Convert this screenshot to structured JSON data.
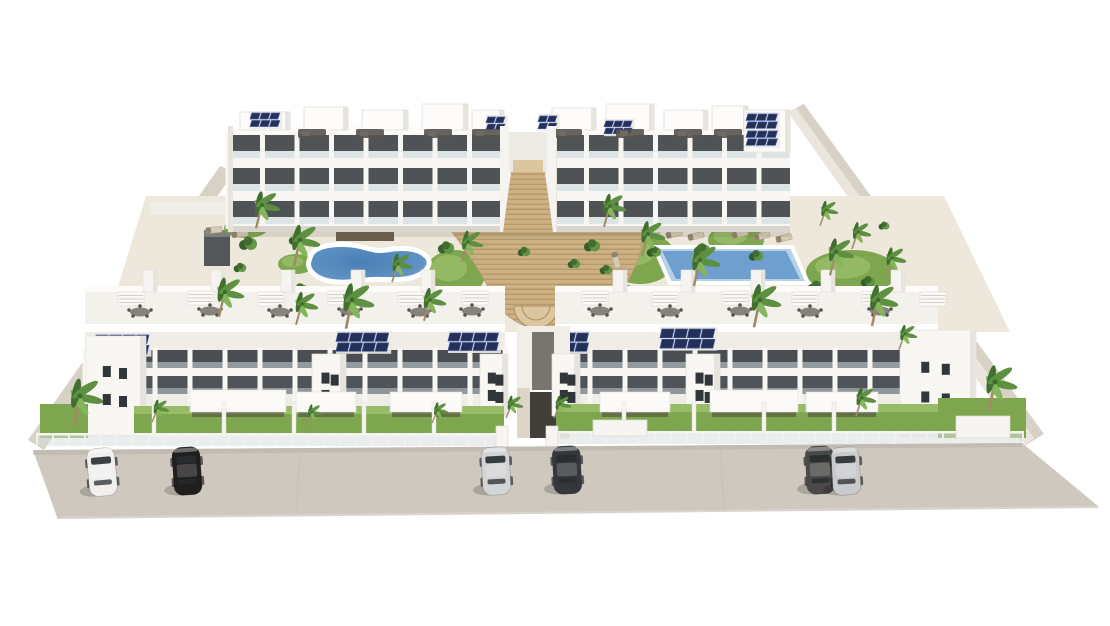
{
  "meta": {
    "type": "3d-architectural-rendering",
    "description": "Aerial 3D render of a white Mediterranean apartment complex: two rows of three-storey blocks around a landscaped courtyard with a kidney-shaped pool and a rectangular lap pool, curved timber deck stairs in the centre, palm trees, rooftop terraces with furniture, navy solar-panel arrays, a glass perimeter fence and six cars parked on a beige access road.",
    "background": "#ffffff",
    "floors_per_block": 3,
    "car_count": 6,
    "pool_count": 2
  },
  "palette": {
    "facade_white": "#f8f6f2",
    "facade_light": "#fdfcfa",
    "facade_shade": "#e7e4de",
    "facade_deep": "#d9d5ce",
    "window_dark": "#31363b",
    "glass_rail": "#ccd8dd",
    "solar_navy": "#233058",
    "solar_line": "#46579a",
    "palm_dark": "#3e6a2e",
    "palm_mid": "#5f9140",
    "palm_light": "#86b75e",
    "grass": "#7ea64e",
    "grass_light": "#a3c572",
    "bush_dark": "#2f5a26",
    "sand": "#ede8db",
    "deck_wood": "#cdb183",
    "deck_line": "#ab8f63",
    "deck_light": "#dcc6a0",
    "pool_deep": "#4a80b6",
    "pool_mid": "#6f9fce",
    "pool_pale": "#b7d2e6",
    "road": "#cfc8bf",
    "road_shade": "#b8b0a6",
    "wall_tan": "#d8d1c5",
    "furniture_gray": "#807c77",
    "furniture_dark": "#57534f",
    "trunk": "#a08b66",
    "canopy_shadow": "#4a453f",
    "alley_dark": "#413d38"
  },
  "scene": {
    "pools": [
      {
        "name": "kidney-pool",
        "shape": "organic"
      },
      {
        "name": "lap-pool",
        "shape": "rectangular"
      }
    ],
    "cars": [
      {
        "color_name": "white",
        "hex": "#f0efed",
        "x": 102,
        "y": 472,
        "rot": -5
      },
      {
        "color_name": "black",
        "hex": "#211f1e",
        "x": 187,
        "y": 471,
        "rot": -4
      },
      {
        "color_name": "silver",
        "hex": "#d3d4d6",
        "x": 496,
        "y": 471,
        "rot": -3
      },
      {
        "color_name": "graphite",
        "hex": "#35383b",
        "x": 567,
        "y": 470,
        "rot": -3
      },
      {
        "color_name": "dark-gray",
        "hex": "#4b4a48",
        "x": 820,
        "y": 470,
        "rot": -3
      },
      {
        "color_name": "silver",
        "hex": "#c9cacc",
        "x": 846,
        "y": 471,
        "rot": -3
      }
    ],
    "palms": [
      {
        "x": 262,
        "y": 205,
        "s": 0.9
      },
      {
        "x": 300,
        "y": 240,
        "s": 1.0
      },
      {
        "x": 225,
        "y": 292,
        "s": 0.95
      },
      {
        "x": 352,
        "y": 300,
        "s": 1.1
      },
      {
        "x": 398,
        "y": 264,
        "s": 0.7
      },
      {
        "x": 302,
        "y": 304,
        "s": 0.8
      },
      {
        "x": 468,
        "y": 242,
        "s": 0.75
      },
      {
        "x": 610,
        "y": 206,
        "s": 0.8
      },
      {
        "x": 648,
        "y": 234,
        "s": 0.85
      },
      {
        "x": 700,
        "y": 260,
        "s": 1.0
      },
      {
        "x": 760,
        "y": 300,
        "s": 1.05
      },
      {
        "x": 836,
        "y": 252,
        "s": 0.9
      },
      {
        "x": 878,
        "y": 300,
        "s": 1.0
      },
      {
        "x": 826,
        "y": 210,
        "s": 0.6
      },
      {
        "x": 858,
        "y": 232,
        "s": 0.65
      },
      {
        "x": 892,
        "y": 258,
        "s": 0.7
      },
      {
        "x": 80,
        "y": 396,
        "s": 1.15
      },
      {
        "x": 158,
        "y": 408,
        "s": 0.55
      },
      {
        "x": 995,
        "y": 382,
        "s": 1.1
      },
      {
        "x": 862,
        "y": 398,
        "s": 0.7
      },
      {
        "x": 512,
        "y": 404,
        "s": 0.55
      },
      {
        "x": 560,
        "y": 404,
        "s": 0.55
      },
      {
        "x": 312,
        "y": 412,
        "s": 0.5
      },
      {
        "x": 438,
        "y": 410,
        "s": 0.5
      },
      {
        "x": 905,
        "y": 334,
        "s": 0.6
      },
      {
        "x": 430,
        "y": 300,
        "s": 0.8
      }
    ],
    "bushes": [
      {
        "x": 248,
        "y": 244,
        "s": 1.0
      },
      {
        "x": 296,
        "y": 240,
        "s": 0.8
      },
      {
        "x": 446,
        "y": 248,
        "s": 0.9
      },
      {
        "x": 524,
        "y": 252,
        "s": 0.7
      },
      {
        "x": 592,
        "y": 246,
        "s": 0.9
      },
      {
        "x": 654,
        "y": 252,
        "s": 0.8
      },
      {
        "x": 702,
        "y": 250,
        "s": 0.9
      },
      {
        "x": 756,
        "y": 256,
        "s": 0.8
      },
      {
        "x": 300,
        "y": 290,
        "s": 0.9
      },
      {
        "x": 436,
        "y": 292,
        "s": 0.8
      },
      {
        "x": 628,
        "y": 292,
        "s": 0.9
      },
      {
        "x": 816,
        "y": 288,
        "s": 1.0
      },
      {
        "x": 868,
        "y": 282,
        "s": 0.8
      },
      {
        "x": 240,
        "y": 268,
        "s": 0.7
      },
      {
        "x": 574,
        "y": 264,
        "s": 0.7
      },
      {
        "x": 606,
        "y": 270,
        "s": 0.7
      },
      {
        "x": 680,
        "y": 228,
        "s": 0.7
      },
      {
        "x": 884,
        "y": 226,
        "s": 0.6
      }
    ],
    "grass_beds": [
      {
        "x": 455,
        "y": 274,
        "rx": 30,
        "ry": 24
      },
      {
        "x": 640,
        "y": 258,
        "rx": 36,
        "ry": 26
      },
      {
        "x": 852,
        "y": 272,
        "rx": 46,
        "ry": 22
      },
      {
        "x": 736,
        "y": 240,
        "rx": 28,
        "ry": 16
      },
      {
        "x": 586,
        "y": 300,
        "rx": 22,
        "ry": 12
      },
      {
        "x": 296,
        "y": 264,
        "rx": 18,
        "ry": 10
      },
      {
        "x": 246,
        "y": 228,
        "rx": 22,
        "ry": 10
      }
    ],
    "solar_arrays_back": [
      {
        "x": 252,
        "y": 113,
        "cols": 3,
        "rows": 2,
        "s": 0.75
      },
      {
        "x": 488,
        "y": 117,
        "cols": 2,
        "rows": 2,
        "s": 0.7
      },
      {
        "x": 540,
        "y": 116,
        "cols": 2,
        "rows": 2,
        "s": 0.7
      },
      {
        "x": 606,
        "y": 121,
        "cols": 3,
        "rows": 2,
        "s": 0.7
      },
      {
        "x": 748,
        "y": 114,
        "cols": 3,
        "rows": 2,
        "s": 0.8
      },
      {
        "x": 748,
        "y": 131,
        "cols": 3,
        "rows": 2,
        "s": 0.8
      }
    ],
    "solar_arrays_front": [
      {
        "x": 96,
        "y": 335,
        "cols": 4,
        "rows": 2,
        "s": 1.1
      },
      {
        "x": 338,
        "y": 333,
        "cols": 4,
        "rows": 2,
        "s": 1.05
      },
      {
        "x": 450,
        "y": 333,
        "cols": 4,
        "rows": 2,
        "s": 1.0
      },
      {
        "x": 564,
        "y": 333,
        "cols": 2,
        "rows": 2,
        "s": 1.05
      },
      {
        "x": 662,
        "y": 329,
        "cols": 4,
        "rows": 2,
        "s": 1.1
      },
      {
        "x": 908,
        "y": 333,
        "cols": 3,
        "rows": 2,
        "s": 1.1
      }
    ],
    "roof_boxes_back": [
      {
        "x": 240,
        "y": 112,
        "w": 50,
        "h": 18
      },
      {
        "x": 304,
        "y": 107,
        "w": 44,
        "h": 23
      },
      {
        "x": 362,
        "y": 110,
        "w": 46,
        "h": 20
      },
      {
        "x": 422,
        "y": 104,
        "w": 46,
        "h": 26
      },
      {
        "x": 472,
        "y": 110,
        "w": 32,
        "h": 20
      },
      {
        "x": 552,
        "y": 108,
        "w": 44,
        "h": 22
      },
      {
        "x": 606,
        "y": 104,
        "w": 48,
        "h": 26
      },
      {
        "x": 664,
        "y": 110,
        "w": 44,
        "h": 20
      },
      {
        "x": 712,
        "y": 106,
        "w": 36,
        "h": 24
      },
      {
        "x": 744,
        "y": 110,
        "w": 46,
        "h": 42
      }
    ],
    "roof_furniture_back": [
      312,
      370,
      438,
      486,
      568,
      630,
      688,
      728
    ],
    "terrace_furniture_front": [
      {
        "x": 140,
        "y": 312
      },
      {
        "x": 210,
        "y": 311
      },
      {
        "x": 280,
        "y": 312
      },
      {
        "x": 350,
        "y": 311
      },
      {
        "x": 420,
        "y": 312
      },
      {
        "x": 472,
        "y": 311
      },
      {
        "x": 600,
        "y": 311
      },
      {
        "x": 670,
        "y": 312
      },
      {
        "x": 740,
        "y": 311
      },
      {
        "x": 810,
        "y": 312
      },
      {
        "x": 880,
        "y": 311
      }
    ],
    "pergola_boxes_front": [
      {
        "x": 118,
        "y": 292
      },
      {
        "x": 188,
        "y": 291
      },
      {
        "x": 258,
        "y": 292
      },
      {
        "x": 328,
        "y": 291
      },
      {
        "x": 398,
        "y": 292
      },
      {
        "x": 462,
        "y": 291
      },
      {
        "x": 582,
        "y": 291
      },
      {
        "x": 652,
        "y": 292
      },
      {
        "x": 722,
        "y": 291
      },
      {
        "x": 792,
        "y": 292
      },
      {
        "x": 862,
        "y": 291
      },
      {
        "x": 920,
        "y": 292
      }
    ],
    "stair_towers_front": [
      150,
      218,
      288,
      358,
      428,
      620,
      688,
      758,
      828,
      898
    ],
    "facade_towers": [
      {
        "x": 86,
        "y": 336,
        "w": 60,
        "h": 100
      },
      {
        "x": 312,
        "y": 354,
        "w": 34,
        "h": 62
      },
      {
        "x": 480,
        "y": 354,
        "w": 28,
        "h": 62
      },
      {
        "x": 552,
        "y": 354,
        "w": 28,
        "h": 62
      },
      {
        "x": 686,
        "y": 354,
        "w": 34,
        "h": 62
      },
      {
        "x": 900,
        "y": 330,
        "w": 76,
        "h": 106
      }
    ],
    "canopies": [
      {
        "x": 190,
        "y": 390,
        "w": 96,
        "h": 22
      },
      {
        "x": 296,
        "y": 392,
        "w": 60,
        "h": 20
      },
      {
        "x": 390,
        "y": 392,
        "w": 72,
        "h": 20
      },
      {
        "x": 600,
        "y": 392,
        "w": 70,
        "h": 20
      },
      {
        "x": 710,
        "y": 390,
        "w": 88,
        "h": 22
      },
      {
        "x": 806,
        "y": 392,
        "w": 72,
        "h": 20
      }
    ],
    "garden_dividers": [
      152,
      222,
      292,
      362,
      432,
      622,
      692,
      762,
      832
    ],
    "fence_segments": [
      {
        "x": 36,
        "y": 433,
        "len": 462
      },
      {
        "x": 558,
        "y": 431,
        "len": 466
      }
    ],
    "gate_walls": [
      {
        "x": 496,
        "y": 426,
        "w": 12,
        "h": 22
      },
      {
        "x": 546,
        "y": 426,
        "w": 12,
        "h": 22
      },
      {
        "x": 593,
        "y": 420,
        "w": 54,
        "h": 16
      },
      {
        "x": 956,
        "y": 416,
        "w": 54,
        "h": 22
      }
    ],
    "loungers": [
      {
        "x": 652,
        "y": 232,
        "r": -14
      },
      {
        "x": 674,
        "y": 234,
        "r": -14
      },
      {
        "x": 696,
        "y": 236,
        "r": -14
      },
      {
        "x": 740,
        "y": 234,
        "r": -14
      },
      {
        "x": 762,
        "y": 236,
        "r": -14
      },
      {
        "x": 784,
        "y": 238,
        "r": -14
      },
      {
        "x": 616,
        "y": 260,
        "r": 75
      },
      {
        "x": 620,
        "y": 282,
        "r": 75
      },
      {
        "x": 214,
        "y": 230,
        "r": -6
      },
      {
        "x": 240,
        "y": 234,
        "r": -6
      }
    ]
  }
}
